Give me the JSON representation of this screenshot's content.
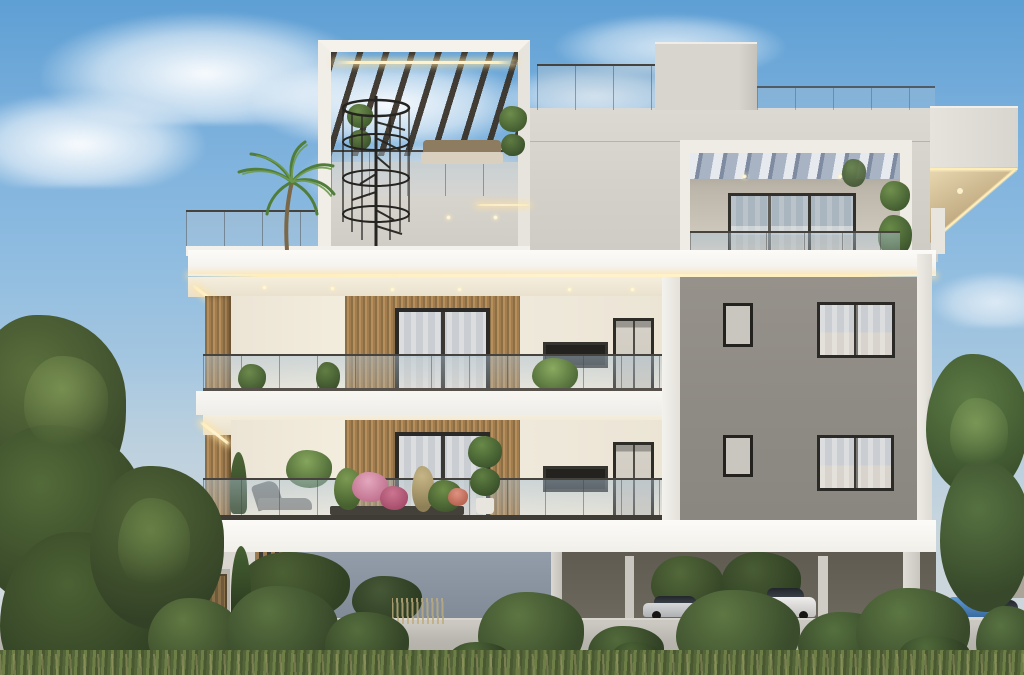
{
  "scene": {
    "type": "3d-architectural-exterior-render",
    "subject": "Modern three-storey apartment building at dusk with rooftop pergola terrace, warm LED accent lighting, balconies, landscaped garden and covered ground-level parking",
    "time_of_day": "dusk",
    "visible_text": "none"
  },
  "palette": {
    "sky_top": "#5e9fd4",
    "sky_horizon": "#c3d3dd",
    "cloud": "#f6fafd",
    "facade_white": "#f0ece3",
    "slab_white": "#f8f7f3",
    "facade_gray": "#8f8a83",
    "wood_slat": "#b08c5c",
    "pergola_timber": "#3a342b",
    "window_frame": "#2c2a26",
    "glass": "#c7ccd1",
    "led_warm": "#ffeebc",
    "foliage_dark": "#3c4a2e",
    "foliage_mid": "#5d7443",
    "foliage_light": "#7f9a5a",
    "perimeter_wall": "#b4b1aa",
    "parking_shadow": "#5d594f",
    "car_blue": "#4a87c8",
    "car_silver": "#c9cbcd",
    "car_white": "#e8e8e6",
    "car_dark_gray": "#4e4d4b"
  },
  "building": {
    "rooftop_terrace": [
      "white portal frame with dark timber pergola louvers",
      "warm LED strip under frame",
      "black spiral staircase",
      "wicker sofa with light cushions",
      "two spiral topiary planters",
      "glass balustrade",
      "palm tree on left roof deck",
      "roof access box",
      "glass roof parapet railing"
    ],
    "penthouse": [
      "recessed balcony with white exposed rafters",
      "three-panel dark-framed sliding glass door with sheer curtains",
      "frameless glass balustrade",
      "stacked ball topiary",
      "ceiling downlights",
      "cantilevered roof corner with warm LED cove lighting on soffit"
    ],
    "typical_floors": [
      "full-width white balcony slabs with recessed downlights",
      "LED strip under slab edges",
      "vertical timber slat feature walls",
      "dark-framed windows with sheer curtains",
      "slim horizontal window and tall glazed door on white wall",
      "frameless glass balustrades",
      "left edge vertical timber slat pillar"
    ],
    "gray_wing": [
      "flat warm-gray facade",
      "small single windows and wide two-pane curtained windows",
      "white corner pilasters",
      "small white ledge"
    ],
    "ground_level": [
      "white floor slab over open pilotis parking",
      "blue-gray recessed garage wall",
      "vertical timber slat screen",
      "white columns",
      "garden storage shed with timber door",
      "light gray perimeter wall"
    ]
  },
  "vehicles": [
    {
      "type": "sedan",
      "color": "silver",
      "location": "under-building parking"
    },
    {
      "type": "hatchback",
      "color": "dark gray",
      "location": "under-building parking"
    },
    {
      "type": "suv",
      "color": "white",
      "location": "under-building parking"
    },
    {
      "type": "suv",
      "color": "blue",
      "location": "driveway right"
    },
    {
      "type": "sedan",
      "color": "silver",
      "location": "driveway far right"
    }
  ],
  "landscape": [
    "large leafy tree left foreground",
    "row of rounded shrubs along street",
    "ornamental grasses and reeds",
    "slender cypress trees",
    "colorful flower planters on first-floor balcony (pink, magenta, coral)",
    "lounge chair on balcony",
    "potted ferns and ball topiaries",
    "leafy tree right of driveway",
    "background trees seen through parking bay"
  ],
  "lighting": [
    "warm LED cove strips under all slab edges",
    "diagonal LED accents at left balcony corners",
    "triangular LED-lit soffit at right roof cantilever",
    "recessed ceiling downlights",
    "lit rafter spots in penthouse ceiling"
  ]
}
